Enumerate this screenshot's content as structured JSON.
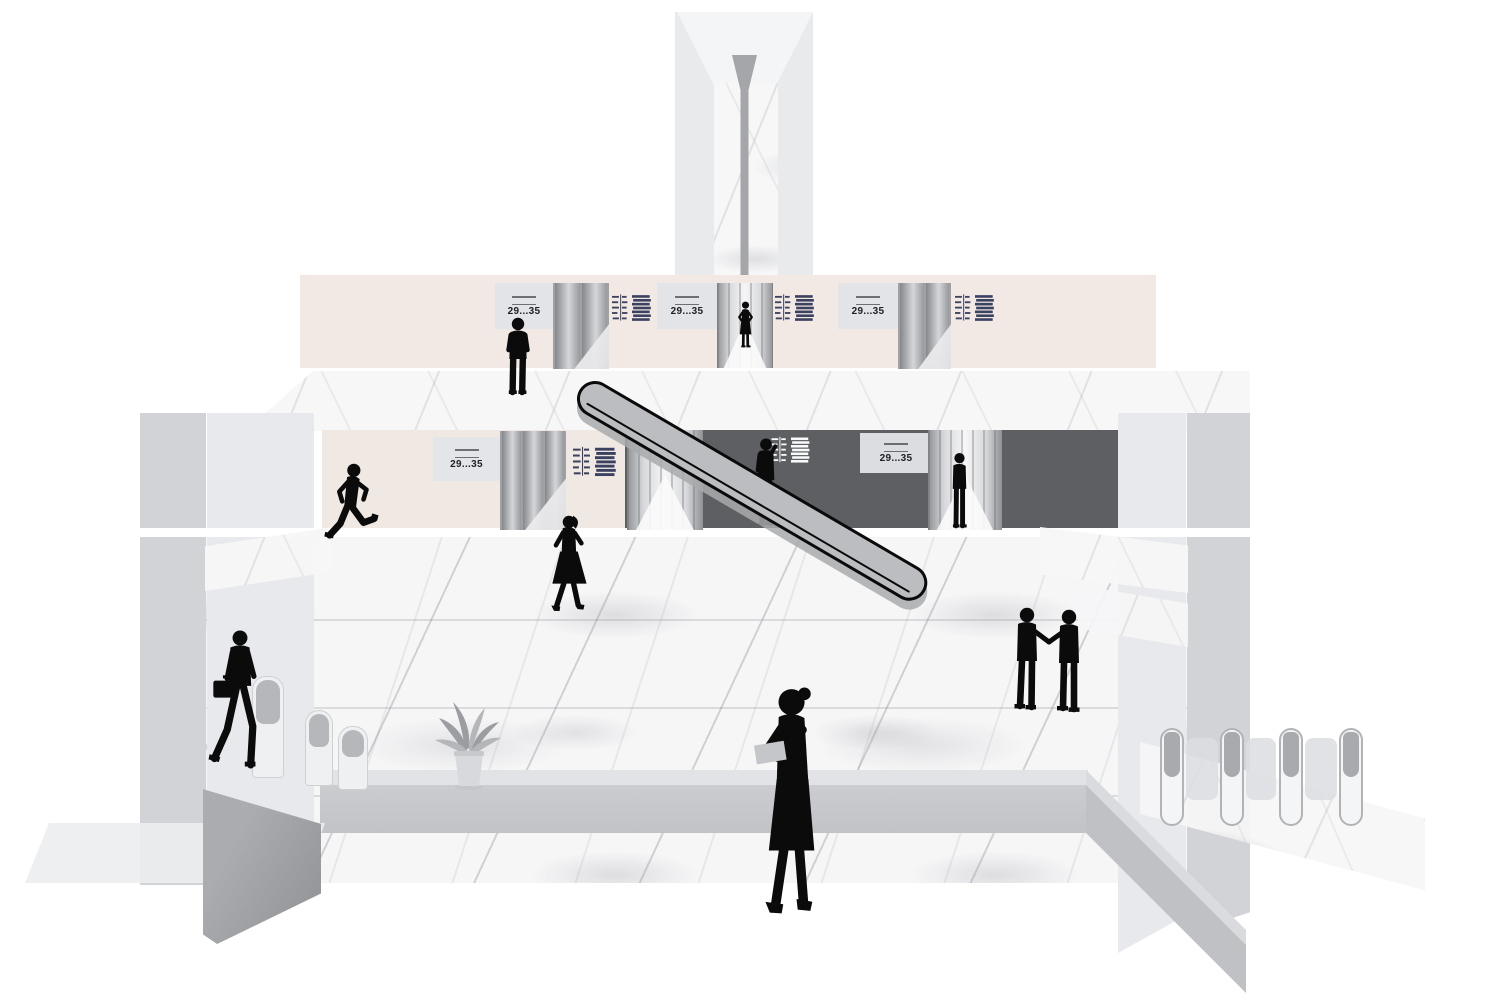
{
  "scene": {
    "type": "architectural-illustration",
    "subject": "Sky-lobby cross-section with elevator banks, escalator, turnstiles and people silhouettes"
  },
  "signs": {
    "upper_level": [
      {
        "label": "29...35"
      },
      {
        "label": "29...35"
      },
      {
        "label": "29...35"
      }
    ],
    "lower_level": [
      {
        "label": "29...35"
      },
      {
        "label": "29...35"
      }
    ]
  },
  "icons": [
    "floor-directory-icon",
    "stacked-floors-icon"
  ],
  "people": [
    {
      "name": "standing-man",
      "location": "upper level"
    },
    {
      "name": "woman-in-elevator-corridor",
      "location": "upper level"
    },
    {
      "name": "running-man",
      "location": "lower level"
    },
    {
      "name": "walking-woman",
      "location": "main floor"
    },
    {
      "name": "man-on-phone",
      "location": "lower level elevator bank"
    },
    {
      "name": "person-at-elevator",
      "location": "lower level elevator bank"
    },
    {
      "name": "man-with-briefcase",
      "location": "left turnstiles"
    },
    {
      "name": "woman-carrying-item",
      "location": "foreground"
    },
    {
      "name": "two-men-shaking-hands",
      "location": "main floor right"
    }
  ],
  "colors": {
    "wall_blush": "#f2e8e4",
    "wall_charcoal": "#5d5f62",
    "marble_base": "#f6f6f7",
    "pillar_light": "#e8e9ec",
    "pillar_medium": "#d2d3d6",
    "escalator_gray": "#bcbdc0",
    "outline_black": "#0b0b0c",
    "directory_navy": "#3b4260",
    "sign_panel": "#e3e4e7"
  }
}
